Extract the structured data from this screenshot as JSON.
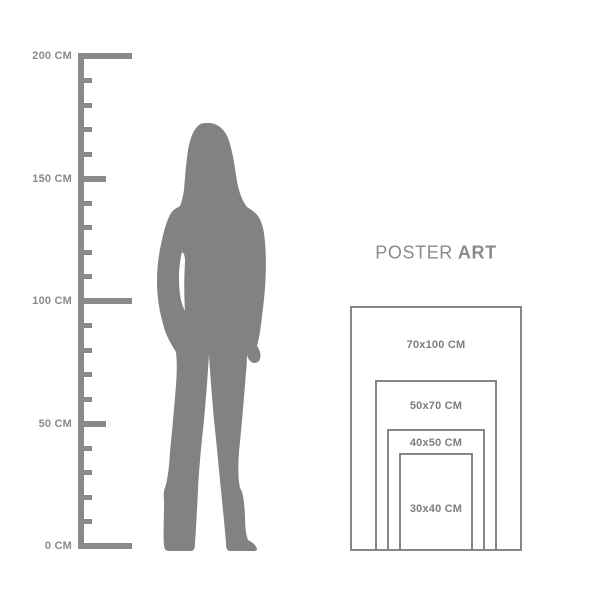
{
  "colors": {
    "gray_primary": "#8a8a8a",
    "silhouette": "#828282",
    "frame_border": "#868686",
    "size_label_text": "#7d7d7d",
    "title_text": "#8a8a8a",
    "background": "#ffffff"
  },
  "ruler": {
    "unit": "CM",
    "min_cm": 0,
    "max_cm": 200,
    "major_step_cm": 50,
    "minor_step_cm": 10,
    "labels": [
      {
        "cm": 200,
        "text": "200 CM"
      },
      {
        "cm": 150,
        "text": "150 CM"
      },
      {
        "cm": 100,
        "text": "100 CM"
      },
      {
        "cm": 50,
        "text": "50 CM"
      },
      {
        "cm": 0,
        "text": "0 CM"
      }
    ]
  },
  "figure": {
    "icon": "standing-woman-silhouette"
  },
  "poster_panel": {
    "title_regular": "POSTER",
    "title_bold": "ART",
    "sizes": [
      {
        "label": "70x100 CM",
        "width_cm": 70,
        "height_cm": 100
      },
      {
        "label": "50x70 CM",
        "width_cm": 50,
        "height_cm": 70
      },
      {
        "label": "40x50 CM",
        "width_cm": 40,
        "height_cm": 50
      },
      {
        "label": "30x40 CM",
        "width_cm": 30,
        "height_cm": 40
      }
    ]
  }
}
